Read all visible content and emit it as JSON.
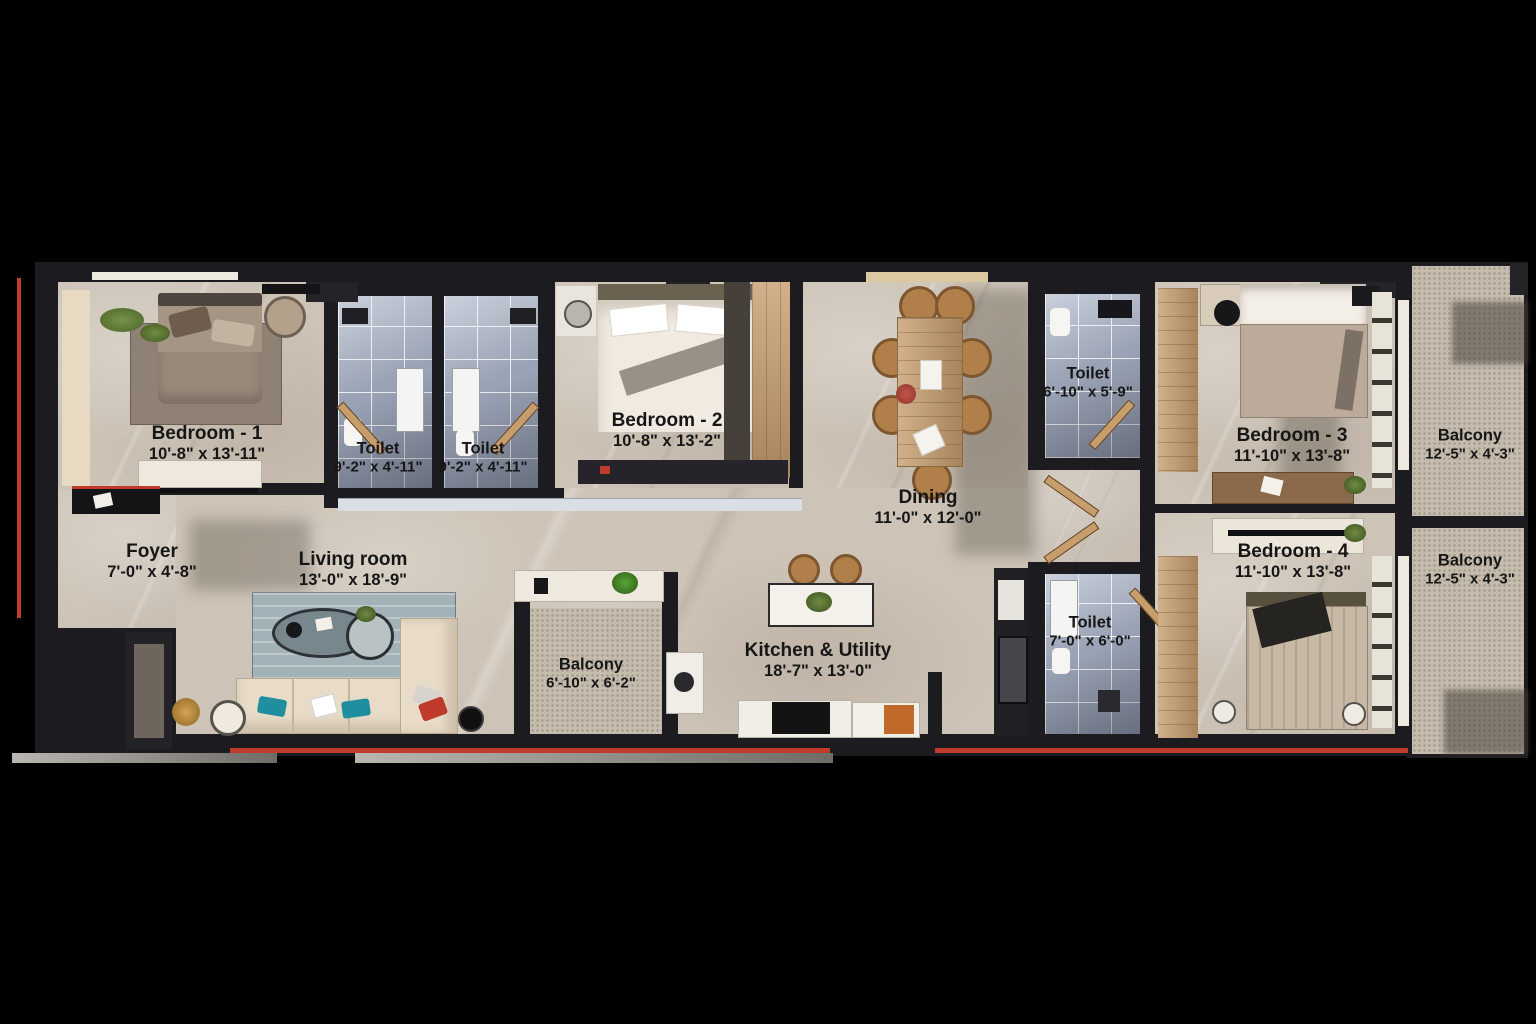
{
  "plan_title": "Apartment Floor Plan",
  "colors": {
    "background": "#000000",
    "wall": "#1c1c20",
    "marble_floor": "#cdc3b6",
    "toilet_tile": "#9aa3b5",
    "balcony_floor": "#c6bcae",
    "wood": "#c49a6a",
    "accent_red": "#bf3b2c",
    "label_text": "#161616"
  },
  "rooms": [
    {
      "name": "Bedroom - 1",
      "dims": "10'-8\" x 13'-11\""
    },
    {
      "name": "Toilet",
      "dims": "9'-2\" x 4'-11\""
    },
    {
      "name": "Toilet",
      "dims": "9'-2\" x 4'-11\""
    },
    {
      "name": "Bedroom - 2",
      "dims": "10'-8\" x 13'-2\""
    },
    {
      "name": "Dining",
      "dims": "11'-0\" x 12'-0\""
    },
    {
      "name": "Toilet",
      "dims": "6'-10\" x 5'-9\""
    },
    {
      "name": "Bedroom - 3",
      "dims": "11'-10\" x 13'-8\""
    },
    {
      "name": "Balcony",
      "dims": "12'-5\" x 4'-3\""
    },
    {
      "name": "Bedroom - 4",
      "dims": "11'-10\" x 13'-8\""
    },
    {
      "name": "Balcony",
      "dims": "12'-5\" x 4'-3\""
    },
    {
      "name": "Foyer",
      "dims": "7'-0\" x 4'-8\""
    },
    {
      "name": "Living room",
      "dims": "13'-0\" x 18'-9\""
    },
    {
      "name": "Balcony",
      "dims": "6'-10\" x 6'-2\""
    },
    {
      "name": "Kitchen & Utility",
      "dims": "18'-7\" x 13'-0\""
    },
    {
      "name": "Toilet",
      "dims": "7'-0\" x 6'-0\""
    }
  ]
}
